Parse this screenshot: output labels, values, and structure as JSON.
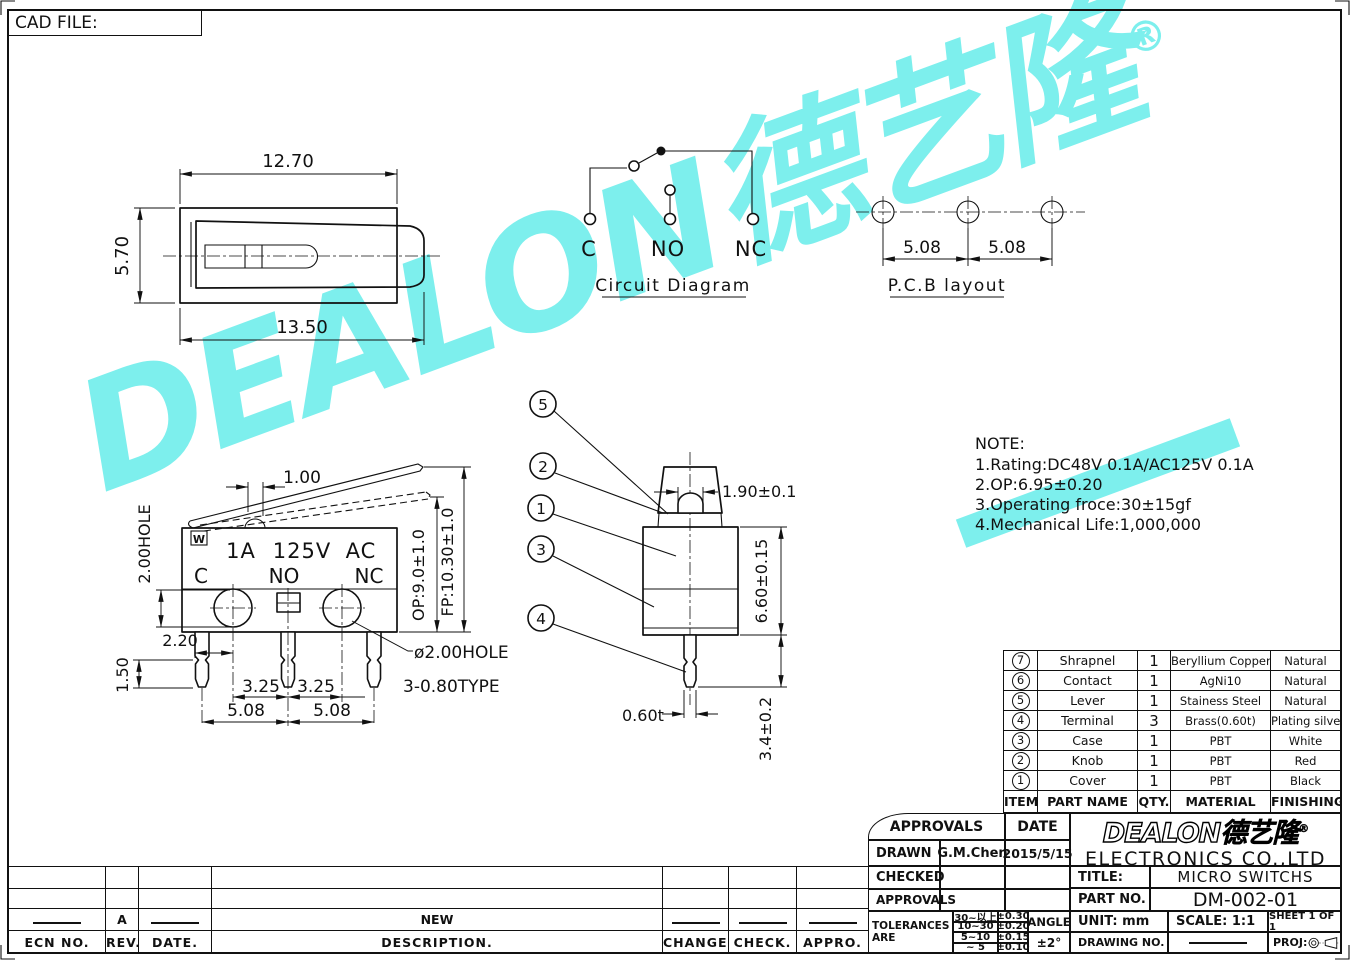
{
  "watermark": {
    "text": "DEALON德艺隆",
    "reg": "®",
    "color": "#7DEFED"
  },
  "cad_file_label": "CAD FILE:",
  "top_view": {
    "dim_top": "12.70",
    "dim_left": "5.70",
    "dim_bottom": "13.50"
  },
  "circuit": {
    "labels": [
      "C",
      "NO",
      "NC"
    ],
    "title": "Circuit Diagram"
  },
  "pcb": {
    "title": "P.C.B layout",
    "dims": [
      "5.08",
      "5.08"
    ]
  },
  "front": {
    "mark": "W",
    "rating": [
      "1A",
      "125V",
      "AC"
    ],
    "terminals": [
      "C",
      "NO",
      "NC"
    ],
    "dims": {
      "d100": "1.00",
      "holev": "2.00HOLE",
      "d220": "2.20",
      "d150": "1.50",
      "d325a": "3.25",
      "d325b": "3.25",
      "d508a": "5.08",
      "d508b": "5.08",
      "op": "OP:9.0±1.0",
      "fp": "FP:10.30±1.0",
      "hole": "ø2.00HOLE",
      "type": "3-0.80TYPE"
    }
  },
  "side": {
    "balloons": [
      "5",
      "2",
      "1",
      "3",
      "4"
    ],
    "dims": {
      "knob": "1.90±0.1",
      "body": "6.60±0.15",
      "pin": "3.4±0.2",
      "thick": "0.60t"
    }
  },
  "note": {
    "title": "NOTE:",
    "lines": [
      "1.Rating:DC48V  0.1A/AC125V  0.1A",
      "2.OP:6.95±0.20",
      "3.Operating  froce:30±15gf",
      "4.Mechanical  Life:1,000,000"
    ]
  },
  "parts": {
    "headers": [
      "ITEM",
      "PART NAME",
      "QTY.",
      "MATERIAL",
      "FINISHING"
    ],
    "rows": [
      {
        "n": "7",
        "name": "Shrapnel",
        "qty": "1",
        "mat": "Beryllium  Copper",
        "fin": "Natural"
      },
      {
        "n": "6",
        "name": "Contact",
        "qty": "1",
        "mat": "AgNi10",
        "fin": "Natural"
      },
      {
        "n": "5",
        "name": "Lever",
        "qty": "1",
        "mat": "Stainess  Steel",
        "fin": "Natural"
      },
      {
        "n": "4",
        "name": "Terminal",
        "qty": "3",
        "mat": "Brass(0.60t)",
        "fin": "Plating  silver"
      },
      {
        "n": "3",
        "name": "Case",
        "qty": "1",
        "mat": "PBT",
        "fin": "White"
      },
      {
        "n": "2",
        "name": "Knob",
        "qty": "1",
        "mat": "PBT",
        "fin": "Red"
      },
      {
        "n": "1",
        "name": "Cover",
        "qty": "1",
        "mat": "PBT",
        "fin": "Black"
      }
    ]
  },
  "titleblock": {
    "approvals_header": "APPROVALS",
    "date_header": "DATE",
    "drawn_label": "DRAWN",
    "drawn_by": "G.M.Chen",
    "drawn_date": "2015/5/15",
    "checked_label": "CHECKED",
    "approvals_label": "APPROVALS",
    "tolerances_label": "TOLERANCES  ARE",
    "tol_rows": [
      [
        "30~以上",
        "±0.30"
      ],
      [
        "10~30",
        "±0.20"
      ],
      [
        "5~10",
        "±0.15"
      ],
      [
        "~ 5",
        "±0.10"
      ]
    ],
    "angle_label": "ANGLE",
    "angle_val": "±2°",
    "company_logo": "DEALON",
    "company_logo_cjk": "德艺隆",
    "reg": "®",
    "company": "ELECTRONICS  CO.,LTD",
    "title_label": "TITLE:",
    "title_val": "MICRO  SWITCHS",
    "part_label": "PART  NO.",
    "part_val": "DM-002-01",
    "unit": "UNIT:  mm",
    "scale": "SCALE:   1:1",
    "sheet": "SHEET    1  OF  1",
    "drawing_label": "DRAWING  NO.",
    "drawing_no_dash": "——",
    "proj_label": "PROJ:"
  },
  "revision": {
    "headers": [
      "ECN  NO.",
      "REV.",
      "DATE.",
      "DESCRIPTION.",
      "CHANGE.",
      "CHECK.",
      "APPRO."
    ],
    "row": [
      "——",
      "A",
      "——",
      "NEW",
      "——",
      "——",
      "——"
    ]
  }
}
